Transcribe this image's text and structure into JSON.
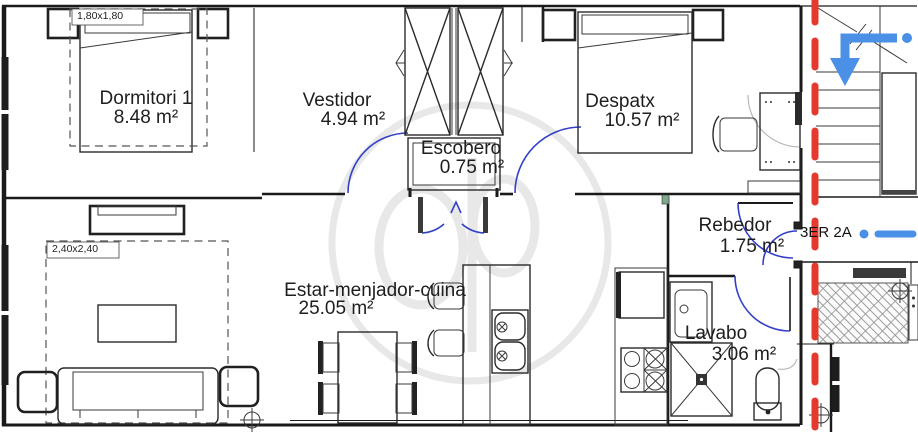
{
  "unit": {
    "label": "3ER 2A"
  },
  "rooms": [
    {
      "name": "Dormitori 1",
      "area": "8.48 m²"
    },
    {
      "name": "Vestidor",
      "area": "4.94 m²"
    },
    {
      "name": "Escobero",
      "area": "0.75 m²"
    },
    {
      "name": "Despatx",
      "area": "10.57 m²"
    },
    {
      "name": "Rebedor",
      "area": "1.75 m²"
    },
    {
      "name": "Estar-menjador-cuina",
      "area": "25.05 m²"
    },
    {
      "name": "Lavabo",
      "area": "3.06 m²"
    }
  ],
  "dimensions": {
    "bed_zone": "1,80x1,80",
    "sofa_zone": "2,40x2,40"
  },
  "colors": {
    "wall": "#1a1a1a",
    "door_blue": "#3240c8",
    "note_blue": "#4a90e6",
    "boundary_red": "#e6392e",
    "watermark": "#e4e4e4"
  }
}
